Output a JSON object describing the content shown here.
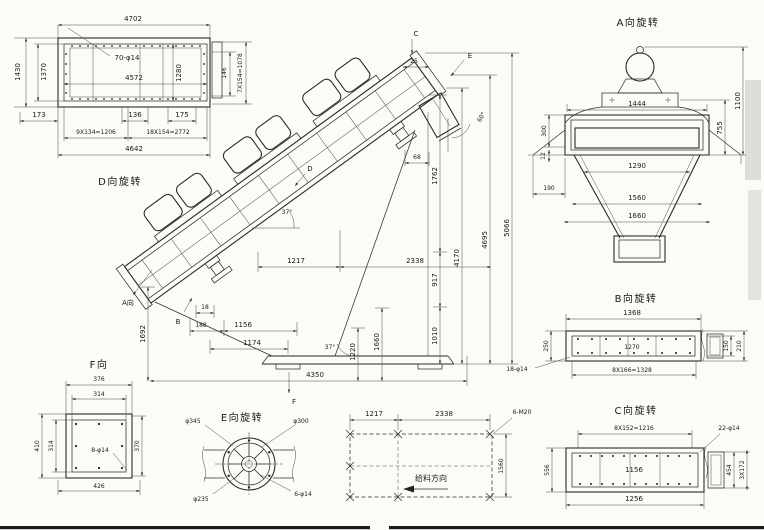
{
  "colors": {
    "ink": "#2a2a2a",
    "paper": "#fbfbf8"
  },
  "views": {
    "d": {
      "title": "D向旋转",
      "top": "4702",
      "inner_width": "4572",
      "holes": "70-φ14",
      "left_outer": "1430",
      "left_inner": "1370",
      "right_inner": "1280",
      "right_margin": "146",
      "right_pitch": "7X154=1078",
      "b173": "173",
      "b136": "136",
      "b175": "175",
      "pitch_small": "9X134=1206",
      "pitch_large": "18X154=2772",
      "total": "4642"
    },
    "main": {
      "a": "A向",
      "b": "B",
      "c": "C",
      "d": "D",
      "e": "E",
      "f": "F",
      "angle_body": "37°",
      "angle_support": "37°",
      "angle_chute": "60°",
      "d25": "25",
      "d68": "68",
      "d1217": "1217",
      "d2338": "2338",
      "d1762": "1762",
      "d917": "917",
      "d1010": "1010",
      "d4170": "4170",
      "d4695": "4695",
      "d5066": "5066",
      "d1692": "1692",
      "d18": "18",
      "d188": "188",
      "d1156": "1156",
      "d1174": "1174",
      "d1220": "1220",
      "d1660": "1660",
      "d4350": "4350"
    },
    "a": {
      "title": "A向旋转",
      "w1444": "1444",
      "h1100": "1100",
      "h755": "755",
      "h300": "300",
      "h12": "12",
      "w190": "190",
      "w1290": "1290",
      "w1560": "1560",
      "w1660": "1660"
    },
    "b": {
      "title": "B向旋转",
      "top": "1368",
      "inner": "1270",
      "left": "250",
      "right_outer": "210",
      "right_inner": "150",
      "pitch": "8X166=1328",
      "holes": "18-φ14"
    },
    "c": {
      "title": "C向旋转",
      "pitch": "8X152=1216",
      "holes": "22-φ14",
      "inner": "1156",
      "bottom": "1256",
      "left": "556",
      "right_inner": "454",
      "right_pitch": "3X172"
    },
    "e": {
      "title": "E向旋转",
      "d345": "φ345",
      "d300": "φ300",
      "d235": "φ235",
      "holes": "6-φ14"
    },
    "f": {
      "title": "F向",
      "top": "376",
      "top_inner": "314",
      "left_outer": "410",
      "left_inner": "314",
      "right": "370",
      "bottom": "426",
      "holes": "8-φ14"
    },
    "plan": {
      "span1": "1217",
      "span2": "2338",
      "depth": "1560",
      "bolts": "6-M20",
      "feed": "给料方向"
    }
  }
}
